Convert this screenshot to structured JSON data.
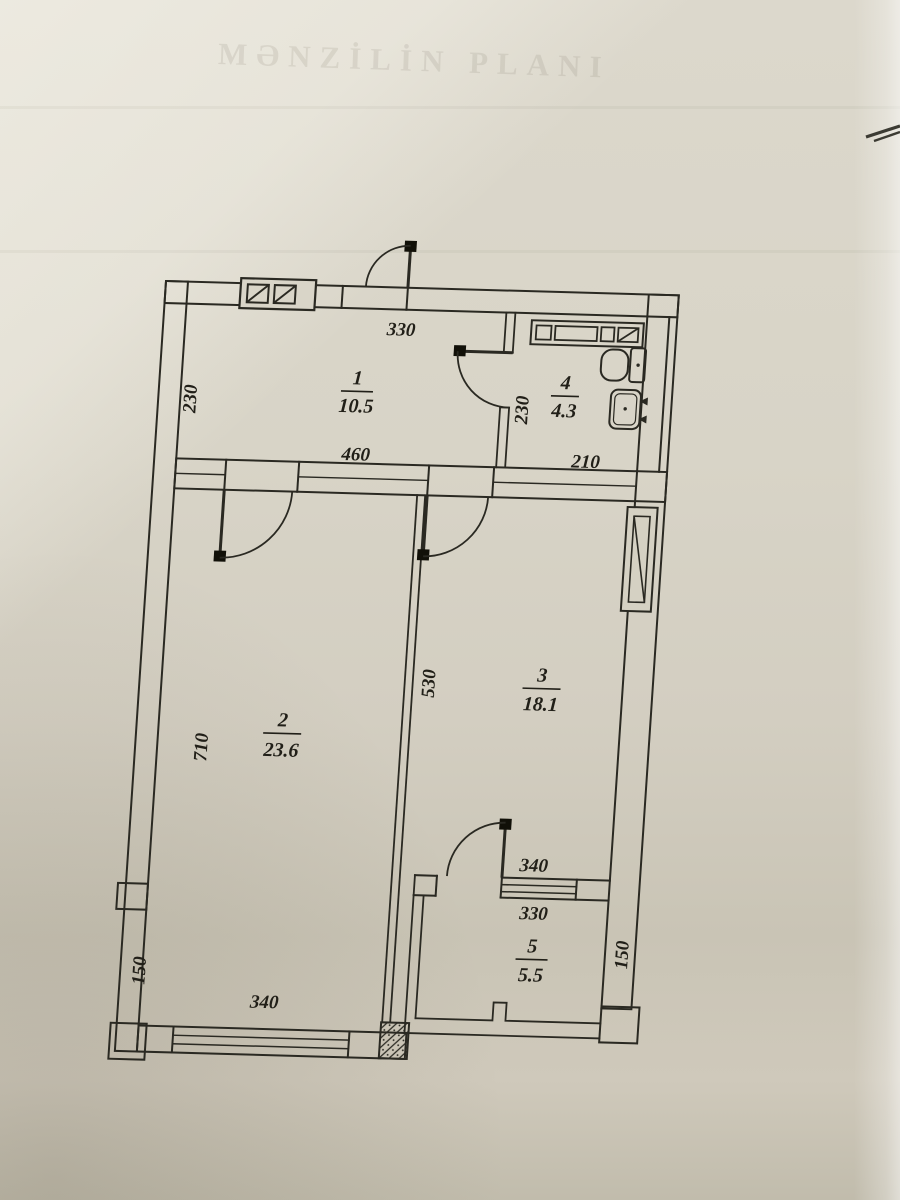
{
  "plan": {
    "watermark": "MƏNZİLİN PLANI",
    "rooms": {
      "r1": {
        "number": "1",
        "area": "10.5"
      },
      "r2": {
        "number": "2",
        "area": "23.6"
      },
      "r3": {
        "number": "3",
        "area": "18.1"
      },
      "r4": {
        "number": "4",
        "area": "4.3"
      },
      "r5": {
        "number": "5",
        "area": "5.5"
      }
    },
    "dims": {
      "entry_top": "330",
      "r1_side": "230",
      "r1_width": "460",
      "r4_side": "230",
      "r4_width": "210",
      "r2_side": "710",
      "r2_r3_partition": "530",
      "r5_door": "340",
      "r5_width": "330",
      "r5_side": "150",
      "left_parapet": "150",
      "r2_window": "340"
    },
    "ink_color": "#2a2922",
    "fixtures": [
      "entry-door",
      "bath-door",
      "room2-door",
      "room3-door",
      "balcony-door",
      "toilet",
      "sink",
      "bath-counter",
      "electrical-panel",
      "vent-shaft",
      "window-room2",
      "window-balcony",
      "hatched-column"
    ]
  }
}
